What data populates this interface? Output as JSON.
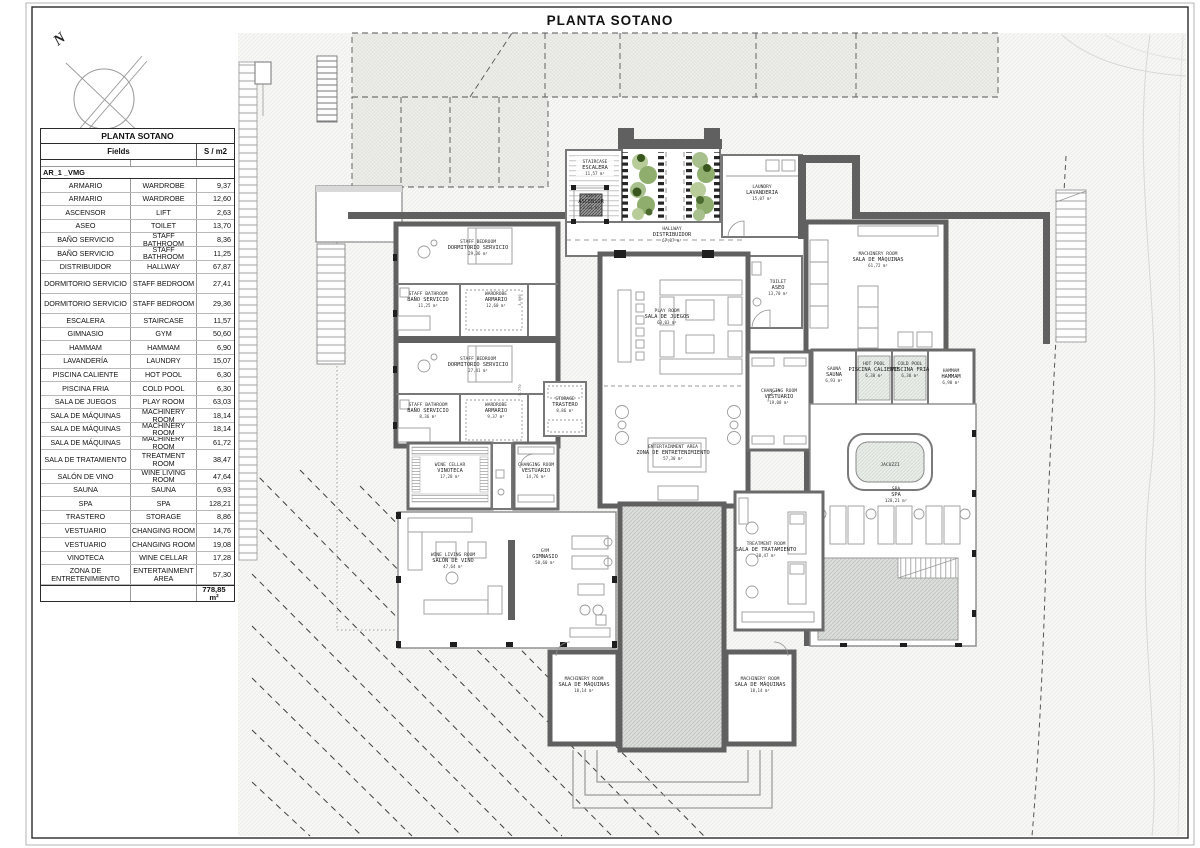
{
  "sheet": {
    "title": "PLANTA SOTANO"
  },
  "north": {
    "label": "N"
  },
  "table": {
    "title": "PLANTA SOTANO",
    "col_fields": "Fields",
    "col_area": "S / m2",
    "group": "AR_1 _VMG",
    "rows": [
      {
        "es": "ARMARIO",
        "en": "WARDROBE",
        "area": "9,37"
      },
      {
        "es": "ARMARIO",
        "en": "WARDROBE",
        "area": "12,60"
      },
      {
        "es": "ASCENSOR",
        "en": "LIFT",
        "area": "2,63"
      },
      {
        "es": "ASEO",
        "en": "TOILET",
        "area": "13,70"
      },
      {
        "es": "BAÑO SERVICIO",
        "en": "STAFF BATHROOM",
        "area": "8,36"
      },
      {
        "es": "BAÑO SERVICIO",
        "en": "STAFF BATHROOM",
        "area": "11,25"
      },
      {
        "es": "DISTRIBUIDOR",
        "en": "HALLWAY",
        "area": "67,87"
      },
      {
        "es": "DORMITORIO SERVICIO",
        "en": "STAFF BEDROOM",
        "area": "27,41",
        "tall": true
      },
      {
        "es": "DORMITORIO SERVICIO",
        "en": "STAFF BEDROOM",
        "area": "29,36",
        "tall": true
      },
      {
        "es": "ESCALERA",
        "en": "STAIRCASE",
        "area": "11,57"
      },
      {
        "es": "GIMNASIO",
        "en": "GYM",
        "area": "50,60"
      },
      {
        "es": "HAMMAM",
        "en": "HAMMAM",
        "area": "6,90"
      },
      {
        "es": "LAVANDERÍA",
        "en": "LAUNDRY",
        "area": "15,07"
      },
      {
        "es": "PISCINA CALIENTE",
        "en": "HOT POOL",
        "area": "6,30"
      },
      {
        "es": "PISCINA FRIA",
        "en": "COLD POOL",
        "area": "6,30"
      },
      {
        "es": "SALA DE JUEGOS",
        "en": "PLAY ROOM",
        "area": "63,03"
      },
      {
        "es": "SALA DE MÁQUINAS",
        "en": "MACHINERY ROOM",
        "area": "18,14"
      },
      {
        "es": "SALA DE MÁQUINAS",
        "en": "MACHINERY ROOM",
        "area": "18,14"
      },
      {
        "es": "SALA DE MÁQUINAS",
        "en": "MACHINERY ROOM",
        "area": "61,72"
      },
      {
        "es": "SALA DE TRATAMIENTO",
        "en": "TREATMENT ROOM",
        "area": "38,47",
        "tall": true
      },
      {
        "es": "SALÓN DE VINO",
        "en": "WINE LIVING ROOM",
        "area": "47,64"
      },
      {
        "es": "SAUNA",
        "en": "SAUNA",
        "area": "6,93"
      },
      {
        "es": "SPA",
        "en": "SPA",
        "area": "128,21"
      },
      {
        "es": "TRASTERO",
        "en": "STORAGE",
        "area": "8,86"
      },
      {
        "es": "VESTUARIO",
        "en": "CHANGING ROOM",
        "area": "14,76"
      },
      {
        "es": "VESTUARIO",
        "en": "CHANGING ROOM",
        "area": "19,08"
      },
      {
        "es": "VINOTECA",
        "en": "WINE CELLAR",
        "area": "17,28"
      },
      {
        "es": "ZONA DE ENTRETENIMIENTO",
        "en": "ENTERTAINMENT AREA",
        "area": "57,30",
        "tall": true
      }
    ],
    "total": "778,85 m²"
  },
  "plan": {
    "rooms": {
      "staircase": {
        "en": "STAIRCASE",
        "es": "ESCALERA",
        "area": "11,57 m²"
      },
      "lift": {
        "en": "LIFT",
        "es": "ASCENSOR",
        "area": "2,63 m²"
      },
      "laundry": {
        "en": "LAUNDRY",
        "es": "LAVANDERIA",
        "area": "15,07 m²"
      },
      "hallway": {
        "en": "HALLWAY",
        "es": "DISTRIBUIDOR",
        "area": "67,87 m²"
      },
      "toilet": {
        "en": "TOILET",
        "es": "ASEO",
        "area": "13,70 m²"
      },
      "machineryMain": {
        "en": "MACHINERY ROOM",
        "es": "SALA DE MÁQUINAS",
        "area": "61,72 m²"
      },
      "staffBedroom1": {
        "en": "STAFF BEDROOM",
        "es": "DORMITORIO SERVICIO",
        "area": "29,36 m²"
      },
      "staffBath1": {
        "en": "STAFF BATHROOM",
        "es": "BAÑO SERVICIO",
        "area": "11,25 m²"
      },
      "wardrobe1": {
        "en": "WARDROBE",
        "es": "ARMARIO",
        "area": "12,60 m²"
      },
      "staffBedroom2": {
        "en": "STAFF BEDROOM",
        "es": "DORMITORIO SERVICIO",
        "area": "27,41 m²"
      },
      "staffBath2": {
        "en": "STAFF BATHROOM",
        "es": "BAÑO SERVICIO",
        "area": "8,36 m²"
      },
      "wardrobe2": {
        "en": "WARDROBE",
        "es": "ARMARIO",
        "area": "9,37 m²"
      },
      "storage": {
        "en": "STORAGE",
        "es": "TRASTERO",
        "area": "8,86 m²"
      },
      "playRoom": {
        "en": "PLAY ROOM",
        "es": "SALA DE JUEGOS",
        "area": "63,03 m²"
      },
      "entertainment": {
        "en": "ENTERTAINMENT AREA",
        "es": "ZONA DE ENTRETENIMIENTO",
        "area": "57,30 m²"
      },
      "wineCellar": {
        "en": "WINE CELLAR",
        "es": "VINOTECA",
        "area": "17,28 m²"
      },
      "changingLeft": {
        "en": "CHANGING ROOM",
        "es": "VESTUARIO",
        "area": "14,76 m²"
      },
      "wineLiving": {
        "en": "WINE LIVING ROOM",
        "es": "SALÓN DE VINO",
        "area": "47,64 m²"
      },
      "gym": {
        "en": "GYM",
        "es": "GIMNASIO",
        "area": "50,60 m²"
      },
      "treatment": {
        "en": "TREATMENT ROOM",
        "es": "SALA DE TRATAMIENTO",
        "area": "38,47 m²"
      },
      "spa": {
        "en": "SPA",
        "es": "SPA",
        "area": "128,21 m²"
      },
      "sauna": {
        "en": "SAUNA",
        "es": "SAUNA",
        "area": "6,93 m²"
      },
      "hotPool": {
        "en": "HOT POOL",
        "es": "PISCINA CALIENTE",
        "area": "6,30 m²"
      },
      "coldPool": {
        "en": "COLD POOL",
        "es": "PISCINA FRIA",
        "area": "6,30 m²"
      },
      "hammam": {
        "en": "HAMMAM",
        "es": "HAMMAM",
        "area": "6,90 m²"
      },
      "changingRight": {
        "en": "CHANGING ROOM",
        "es": "VESTUARIO",
        "area": "19,08 m²"
      },
      "machineryBL": {
        "en": "MACHINERY ROOM",
        "es": "SALA DE MÁQUINAS",
        "area": "18,14 m²"
      },
      "machineryBR": {
        "en": "MACHINERY ROOM",
        "es": "SALA DE MÁQUINAS",
        "area": "18,14 m²"
      }
    },
    "labels": {
      "jacuzzi": "JACUZZI"
    },
    "dims": [
      "3.000",
      "5.770"
    ]
  },
  "colors": {
    "wall": "#606060",
    "accentGreenDark": "#39561f",
    "accentGreen": "#8fae6e",
    "accentGreenLight": "#b8cc9a"
  }
}
